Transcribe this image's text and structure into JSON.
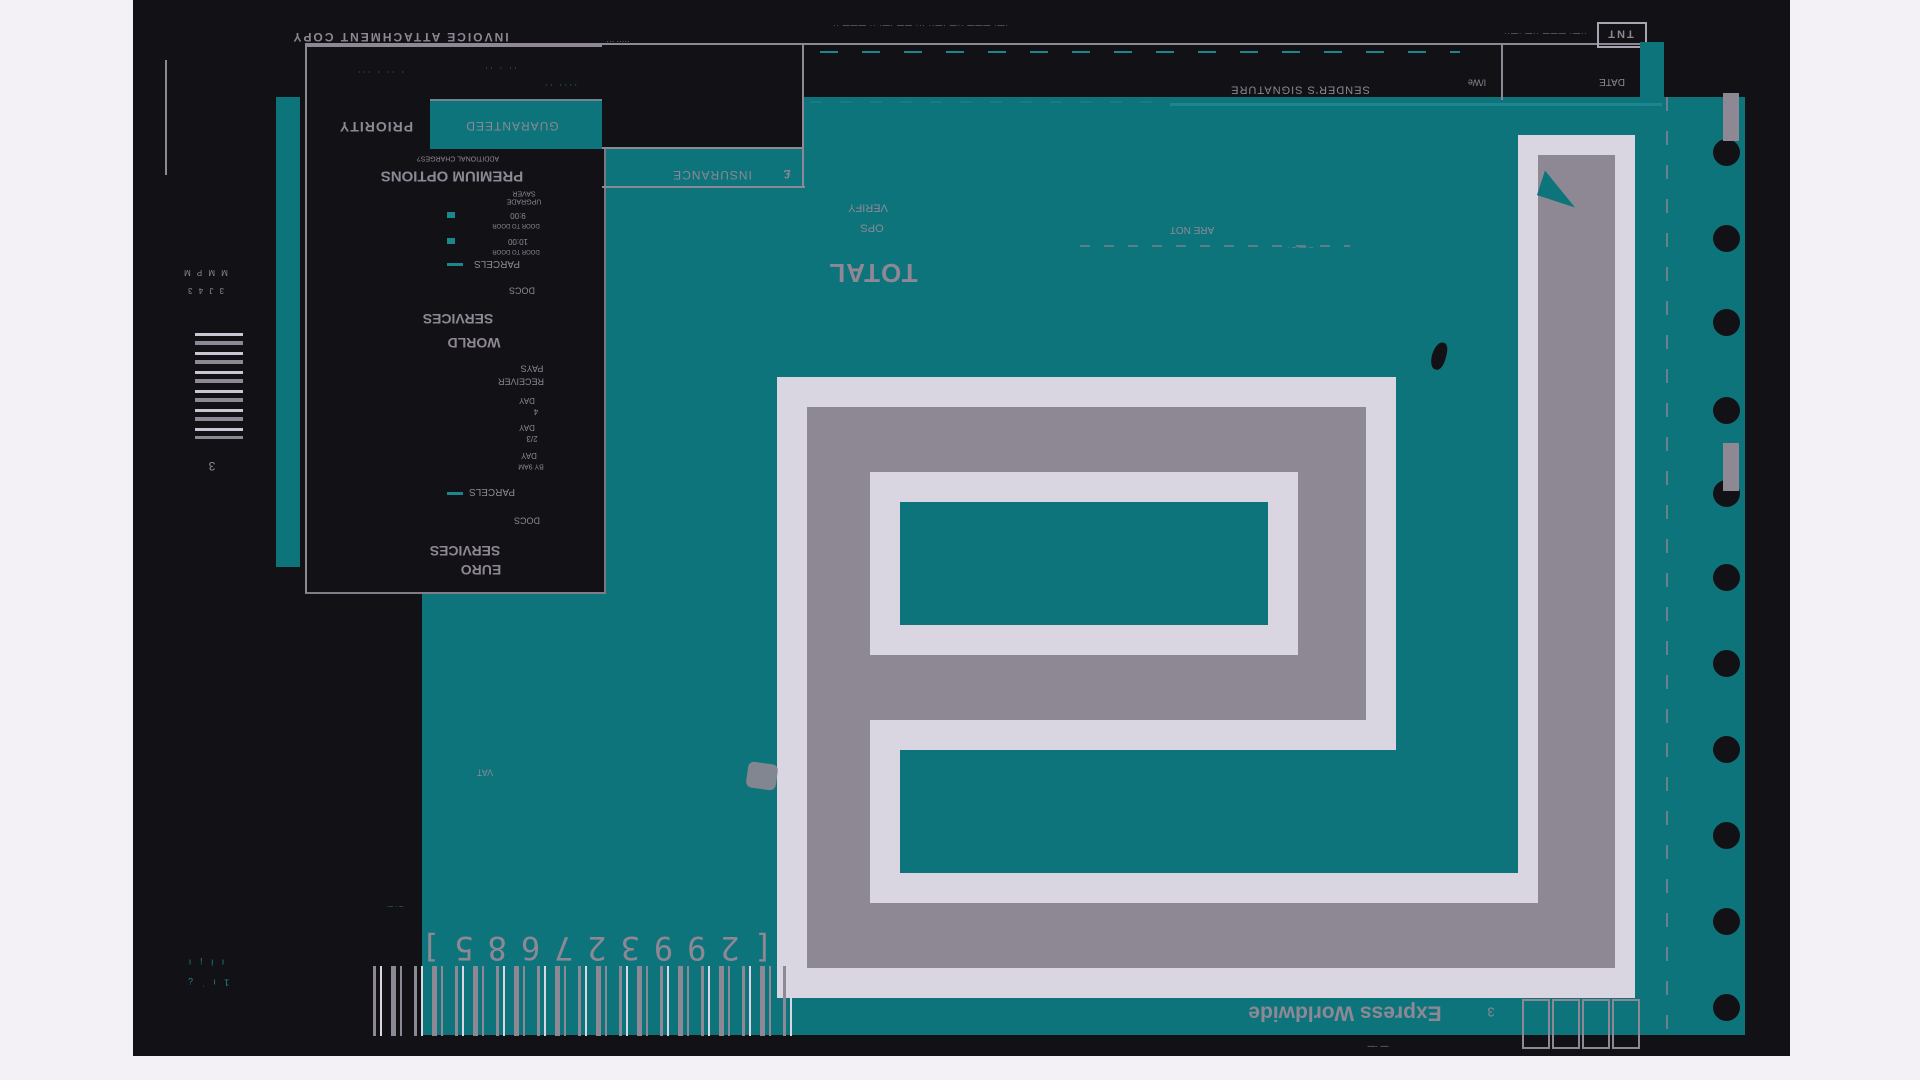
{
  "document_type": "scanned consignment note (rotated 180°)",
  "colors": {
    "teal": "#0e747c",
    "teal_dim": "#1d858d",
    "black": "#121116",
    "gray": "#8e8894",
    "lavender": "#d9d5e1",
    "white": "#f3f1f6"
  },
  "form": {
    "copy_title": "INVOICE ATTACHMENT COPY",
    "brand_logo": "TNT",
    "product_name": "Express Worldwide",
    "consignment_number": "299327685",
    "consignment_display": "[299327685]",
    "header": {
      "date_label": "DATE",
      "i_we": "I/We",
      "signature_label": "SENDER'S SIGNATURE"
    },
    "priority": "PRIORITY",
    "premium_options": {
      "title": "PREMIUM OPTIONS",
      "note": "ADDITIONAL CHARGES?",
      "guaranteed": "GUARANTEED",
      "insurance": "INSURANCE",
      "currency_symbol": "£",
      "options": [
        [
          "SAVER",
          "UPGRADE"
        ],
        [
          "9:00",
          "DOOR TO DOOR"
        ],
        [
          "10:00",
          "DOOR TO DOOR"
        ]
      ]
    },
    "world_services": {
      "title_lines": [
        "WORLD",
        "SERVICES"
      ],
      "items": [
        "PARCELS",
        "DOCS"
      ],
      "sub_options": [
        [
          "RECEIVER",
          "PAYS"
        ],
        [
          "DAY",
          "4"
        ],
        [
          "DAY",
          "2/3"
        ],
        [
          "DAY",
          "BY 9AM"
        ]
      ]
    },
    "euro_services": {
      "title_lines": [
        "EURO",
        "SERVICES"
      ],
      "items": [
        "PARCELS",
        "DOCS"
      ]
    },
    "totals": {
      "total_label": "TOTAL",
      "ops_verify_lines": [
        "OPS",
        "VERIFY"
      ],
      "are_not": "ARE NOT",
      "vat": "VAT"
    },
    "margin_marks": {
      "left_top": [
        "M M  P M",
        "3 J  4 3"
      ],
      "left_mid": "3",
      "box_number": "3",
      "bottom_left": [
        "ı i  ¡ ı",
        "1 ı  ˙ ¿"
      ]
    }
  },
  "labels": [
    {
      "n": "invoice-copy-title",
      "t": "INVOICE ATTACHMENT COPY",
      "x": 400,
      "y": 37,
      "s": 12,
      "w": 1,
      "ls": 2
    },
    {
      "n": "tnt-logo",
      "t": "TNT",
      "x": 1620,
      "y": 33,
      "s": 11,
      "w": 1,
      "ls": 2
    },
    {
      "n": "tnt-small-print",
      "t": "··—· ——— ··— ·—··",
      "x": 1545,
      "y": 33,
      "s": 7,
      "ls": 1
    },
    {
      "n": "i-we-label",
      "t": "I/We",
      "x": 1477,
      "y": 82,
      "s": 9
    },
    {
      "n": "date-label",
      "t": "DATE",
      "x": 1612,
      "y": 81,
      "s": 10
    },
    {
      "n": "senders-signature-label",
      "t": "SENDER'S SIGNATURE",
      "x": 1300,
      "y": 89,
      "s": 11,
      "ls": 1
    },
    {
      "n": "priority-label",
      "t": "PRIORITY",
      "x": 376,
      "y": 127,
      "s": 14,
      "w": 1,
      "ls": 1
    },
    {
      "n": "guaranteed-label",
      "t": "GUARANTEED",
      "x": 512,
      "y": 126,
      "s": 12,
      "ls": 1
    },
    {
      "n": "additional-charges-label",
      "t": "ADDITIONAL CHARGES?",
      "x": 458,
      "y": 158,
      "s": 7
    },
    {
      "n": "premium-options-label",
      "t": "PREMIUM OPTIONS",
      "x": 452,
      "y": 176,
      "s": 15,
      "w": 1
    },
    {
      "n": "option-saver",
      "t": "SAVER",
      "x": 524,
      "y": 193,
      "s": 7
    },
    {
      "n": "option-upgrade",
      "t": "UPGRADE",
      "x": 524,
      "y": 201,
      "s": 7
    },
    {
      "n": "option-900",
      "t": "9:00",
      "x": 518,
      "y": 215,
      "s": 8
    },
    {
      "n": "option-900-door",
      "t": "DOOR TO DOOR",
      "x": 516,
      "y": 225,
      "s": 6
    },
    {
      "n": "option-1000",
      "t": "10:00",
      "x": 518,
      "y": 241,
      "s": 8
    },
    {
      "n": "option-1000-door",
      "t": "DOOR TO DOOR",
      "x": 516,
      "y": 251,
      "s": 6
    },
    {
      "n": "world-parcels-label",
      "t": "PARCELS",
      "x": 497,
      "y": 263,
      "s": 10
    },
    {
      "n": "world-docs-label",
      "t": "DOCS",
      "x": 522,
      "y": 290,
      "s": 9
    },
    {
      "n": "world-services-line2",
      "t": "SERVICES",
      "x": 458,
      "y": 319,
      "s": 14,
      "w": 1
    },
    {
      "n": "world-services-line1",
      "t": "WORLD",
      "x": 474,
      "y": 343,
      "s": 14,
      "w": 1
    },
    {
      "n": "receiver-pays-line2",
      "t": "PAYS",
      "x": 532,
      "y": 368,
      "s": 9
    },
    {
      "n": "receiver-pays-line1",
      "t": "RECEIVER",
      "x": 521,
      "y": 381,
      "s": 9
    },
    {
      "n": "day4-line2",
      "t": "DAY",
      "x": 527,
      "y": 400,
      "s": 8
    },
    {
      "n": "day4-line1",
      "t": "4",
      "x": 536,
      "y": 411,
      "s": 8
    },
    {
      "n": "day23-line2",
      "t": "DAY",
      "x": 527,
      "y": 427,
      "s": 8
    },
    {
      "n": "day23-line1",
      "t": "2/3",
      "x": 532,
      "y": 438,
      "s": 8
    },
    {
      "n": "dayam-line2",
      "t": "DAY",
      "x": 529,
      "y": 455,
      "s": 8
    },
    {
      "n": "dayam-line1",
      "t": "BY 9AM",
      "x": 531,
      "y": 466,
      "s": 7
    },
    {
      "n": "euro-parcels-label",
      "t": "PARCELS",
      "x": 492,
      "y": 491,
      "s": 10
    },
    {
      "n": "euro-docs-label",
      "t": "DOCS",
      "x": 527,
      "y": 520,
      "s": 9
    },
    {
      "n": "euro-services-line2",
      "t": "SERVICES",
      "x": 465,
      "y": 551,
      "s": 14,
      "w": 1
    },
    {
      "n": "euro-services-line1",
      "t": "EURO",
      "x": 481,
      "y": 570,
      "s": 14,
      "w": 1
    },
    {
      "n": "insurance-label",
      "t": "INSURANCE",
      "x": 712,
      "y": 175,
      "s": 12,
      "ls": 1
    },
    {
      "n": "currency-symbol",
      "t": "£",
      "x": 787,
      "y": 174,
      "s": 12,
      "w": 1
    },
    {
      "n": "ops-verify-line2",
      "t": "VERIFY",
      "x": 868,
      "y": 207,
      "s": 11
    },
    {
      "n": "ops-verify-line1",
      "t": "OPS",
      "x": 872,
      "y": 227,
      "s": 11
    },
    {
      "n": "total-label",
      "t": "TOTAL",
      "x": 873,
      "y": 273,
      "s": 26,
      "w": 1,
      "ls": 1
    },
    {
      "n": "are-not-label",
      "t": "ARE NOT",
      "x": 1192,
      "y": 229,
      "s": 10
    },
    {
      "n": "vat-label",
      "t": "VAT",
      "x": 485,
      "y": 772,
      "s": 9
    },
    {
      "n": "consignment-number",
      "t": "[299327685]",
      "x": 590,
      "y": 948,
      "s": 32,
      "ls": 14,
      "mono": 1
    },
    {
      "n": "express-worldwide-label",
      "t": "Express Worldwide",
      "x": 1345,
      "y": 1013,
      "s": 21,
      "w": 1
    },
    {
      "n": "margin-number-3",
      "t": "3",
      "x": 212,
      "y": 466,
      "s": 12
    },
    {
      "n": "box-number-3",
      "t": "3",
      "x": 1491,
      "y": 1012,
      "s": 13
    },
    {
      "n": "margin-marks-row1",
      "t": "M M  P M",
      "x": 205,
      "y": 272,
      "s": 8,
      "ls": 2
    },
    {
      "n": "margin-marks-row2",
      "t": "3 J  4 3",
      "x": 205,
      "y": 290,
      "s": 8,
      "ls": 2
    },
    {
      "n": "bottom-left-marks-row1",
      "t": "ı i  ¡ ı",
      "x": 205,
      "y": 962,
      "s": 9,
      "c": "teal",
      "ls": 3
    },
    {
      "n": "bottom-left-marks-row2",
      "t": "1 ı  ˙ ¿",
      "x": 207,
      "y": 982,
      "s": 9,
      "c": "teal",
      "ls": 3
    },
    {
      "n": "panel-dotted-row1",
      "t": "· ·· · ···",
      "x": 380,
      "y": 72,
      "s": 9,
      "c": "teal",
      "ls": 2
    },
    {
      "n": "panel-dotted-row2",
      "t": "·· · ··",
      "x": 500,
      "y": 68,
      "s": 9,
      "c": "teal",
      "ls": 2
    },
    {
      "n": "panel-dotted-row3",
      "t": "···· ··",
      "x": 560,
      "y": 85,
      "s": 9,
      "c": "teal",
      "ls": 2
    },
    {
      "n": "top-small-print",
      "t": "·—· ——— ··— ·—·· ··· —— ·—· ·· ——— ··",
      "x": 920,
      "y": 25,
      "s": 7,
      "ls": 1
    },
    {
      "n": "legend-small-print",
      "t": "····· ···",
      "x": 618,
      "y": 41,
      "s": 8
    },
    {
      "n": "are-not-small-print",
      "t": "– — – ·",
      "x": 1300,
      "y": 247,
      "s": 8
    },
    {
      "n": "barcode-top-marks",
      "t": "– · –·",
      "x": 395,
      "y": 906,
      "s": 7,
      "c": "teal"
    },
    {
      "n": "express-underline-marks",
      "t": "— ·—",
      "x": 1378,
      "y": 1046,
      "s": 8
    }
  ]
}
